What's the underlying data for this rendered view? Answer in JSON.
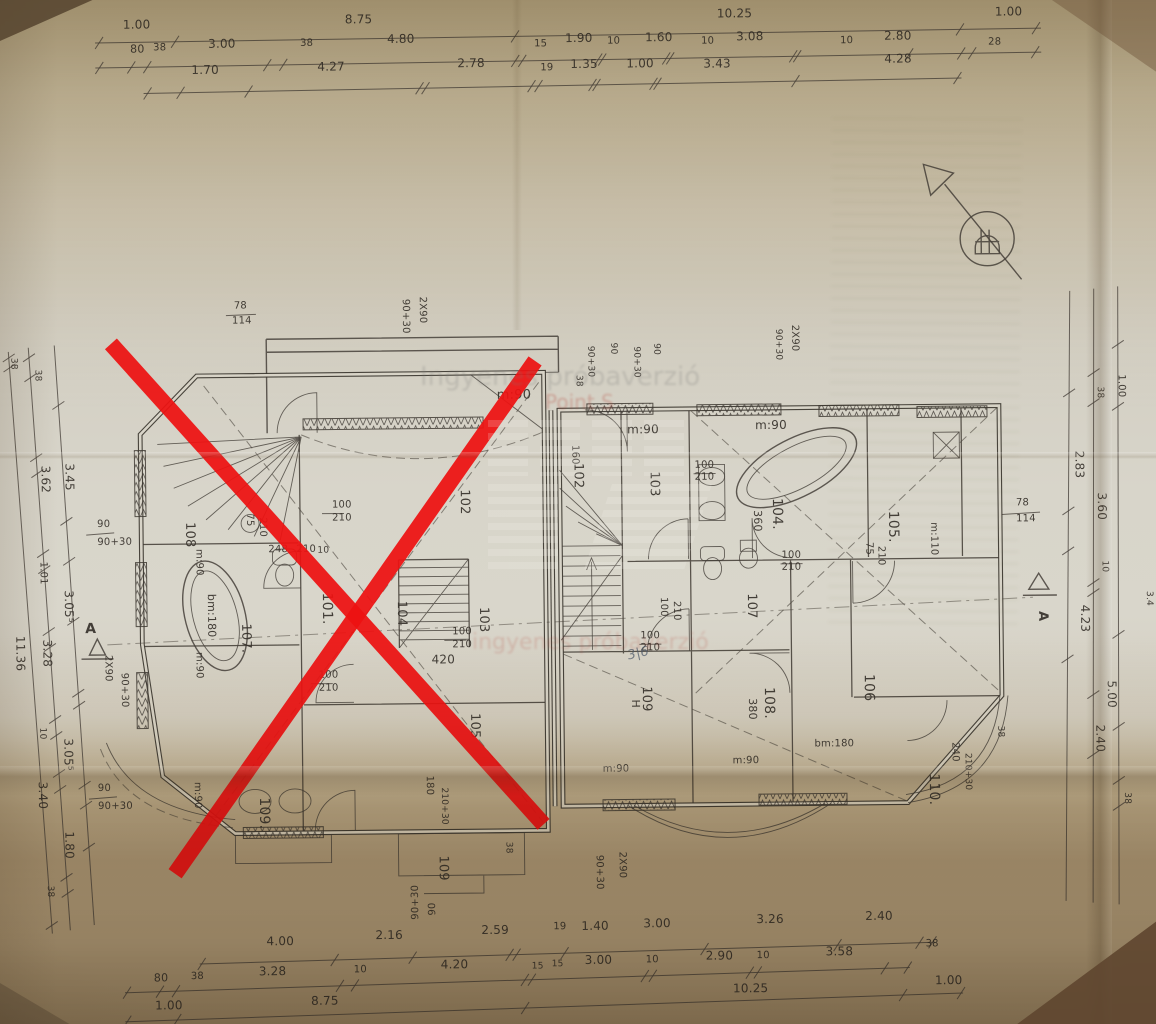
{
  "watermarks": {
    "trial_text_gray": "Ingyenes próbaverzió",
    "trial_text_red": "Point S",
    "trial_text_red2": "ingyenes próbaverzió"
  },
  "rooms": {
    "left_wing_crossed_out": [
      "101.",
      "102",
      "103",
      "104",
      "105",
      "107.",
      "108",
      "109.",
      "109"
    ],
    "right_wing": [
      "102",
      "103",
      "104.",
      "105.",
      "106",
      "107",
      "108.",
      "109",
      "110."
    ]
  },
  "dimension_rows": {
    "top_row1": [
      "1.00",
      "8.75",
      "10.25",
      "1.00"
    ],
    "top_row2": [
      "80",
      "38",
      "3.00",
      "38",
      "4.80",
      "15",
      "1.90",
      "10",
      "1.60",
      "10",
      "3.08",
      "10",
      "2.80",
      "28"
    ],
    "top_row3": [
      "1.70",
      "4.27",
      "2.78",
      "19",
      "1.35",
      "1.00",
      "3.43",
      "4.28"
    ],
    "bottom_row1": [
      "4.00",
      "2.16",
      "2.59",
      "19",
      "1.40",
      "3.00",
      "3.26",
      "2.40",
      "38"
    ],
    "bottom_row2": [
      "80",
      "38",
      "3.28",
      "10",
      "4.20",
      "15",
      "15",
      "3.00",
      "10",
      "2.90",
      "10",
      "3.58"
    ],
    "bottom_row3": [
      "1.00",
      "8.75",
      "10.25",
      "1.00"
    ],
    "left_side": [
      "38",
      "38",
      "3.62",
      "3.45",
      "90",
      "90+30",
      "1.01",
      "3.05⁵",
      "11.36",
      "3.28",
      "10",
      "3.05⁵",
      "3.40",
      "90",
      "90+30",
      "1.80",
      "38"
    ],
    "right_side": [
      "1.00",
      "38",
      "2.83",
      "3.60",
      "10",
      "4.23",
      "5.00",
      "2.40",
      "38",
      "3.4",
      "78",
      "114"
    ]
  },
  "section_markers": [
    "A",
    "A"
  ],
  "labels": [
    {
      "t": "1.00",
      "x": 128,
      "y": 24,
      "g": "dim-top"
    },
    {
      "t": "8.75",
      "x": 350,
      "y": 21,
      "g": "dim-top"
    },
    {
      "t": "10.25",
      "x": 722,
      "y": 19,
      "g": "dim-top"
    },
    {
      "t": "1.00",
      "x": 1000,
      "y": 20,
      "g": "dim-top"
    },
    {
      "t": "80",
      "x": 135,
      "y": 48,
      "s": 11,
      "g": "dim-top"
    },
    {
      "t": "38",
      "x": 158,
      "y": 46,
      "s": 10,
      "g": "dim-top"
    },
    {
      "t": "3.00",
      "x": 213,
      "y": 44,
      "g": "dim-top"
    },
    {
      "t": "38",
      "x": 305,
      "y": 43,
      "s": 10,
      "g": "dim-top"
    },
    {
      "t": "4.80",
      "x": 392,
      "y": 41,
      "g": "dim-top"
    },
    {
      "t": "15",
      "x": 539,
      "y": 46,
      "s": 10,
      "g": "dim-top"
    },
    {
      "t": "1.90",
      "x": 570,
      "y": 42,
      "g": "dim-top"
    },
    {
      "t": "10",
      "x": 612,
      "y": 44,
      "s": 10,
      "g": "dim-top"
    },
    {
      "t": "1.60",
      "x": 650,
      "y": 42,
      "g": "dim-top"
    },
    {
      "t": "10",
      "x": 706,
      "y": 45,
      "s": 10,
      "g": "dim-top"
    },
    {
      "t": "3.08",
      "x": 741,
      "y": 42,
      "g": "dim-top"
    },
    {
      "t": "10",
      "x": 845,
      "y": 46,
      "s": 10,
      "g": "dim-top"
    },
    {
      "t": "2.80",
      "x": 889,
      "y": 43,
      "g": "dim-top"
    },
    {
      "t": "28",
      "x": 993,
      "y": 49,
      "s": 10,
      "g": "dim-top"
    },
    {
      "t": "1.70",
      "x": 196,
      "y": 70,
      "g": "dim-top"
    },
    {
      "t": "4.27",
      "x": 322,
      "y": 68,
      "g": "dim-top"
    },
    {
      "t": "2.78",
      "x": 462,
      "y": 66,
      "g": "dim-top"
    },
    {
      "t": "19",
      "x": 545,
      "y": 70,
      "s": 10,
      "g": "dim-top"
    },
    {
      "t": "1.35",
      "x": 575,
      "y": 68,
      "g": "dim-top"
    },
    {
      "t": "1.00",
      "x": 631,
      "y": 68,
      "g": "dim-top"
    },
    {
      "t": "3.43",
      "x": 708,
      "y": 69,
      "g": "dim-top"
    },
    {
      "t": "4.28",
      "x": 889,
      "y": 66,
      "g": "dim-top"
    },
    {
      "t": "4.00",
      "x": 262,
      "y": 942,
      "g": "dim-bottom"
    },
    {
      "t": "2.16",
      "x": 371,
      "y": 937,
      "g": "dim-bottom"
    },
    {
      "t": "2.59",
      "x": 477,
      "y": 933,
      "g": "dim-bottom"
    },
    {
      "t": "19",
      "x": 549,
      "y": 929,
      "s": 10,
      "g": "dim-bottom"
    },
    {
      "t": "1.40",
      "x": 577,
      "y": 930,
      "g": "dim-bottom"
    },
    {
      "t": "3.00",
      "x": 639,
      "y": 928,
      "g": "dim-bottom"
    },
    {
      "t": "3.26",
      "x": 752,
      "y": 925,
      "g": "dim-bottom"
    },
    {
      "t": "2.40",
      "x": 861,
      "y": 923,
      "g": "dim-bottom"
    },
    {
      "t": "38",
      "x": 921,
      "y": 950,
      "s": 10,
      "g": "dim-bottom"
    },
    {
      "t": "80",
      "x": 149,
      "y": 977,
      "s": 11,
      "g": "dim-bottom"
    },
    {
      "t": "38",
      "x": 186,
      "y": 975,
      "s": 10,
      "g": "dim-bottom"
    },
    {
      "t": "3.28",
      "x": 254,
      "y": 972,
      "g": "dim-bottom"
    },
    {
      "t": "10",
      "x": 349,
      "y": 970,
      "s": 10,
      "g": "dim-bottom"
    },
    {
      "t": "4.20",
      "x": 436,
      "y": 967,
      "g": "dim-bottom"
    },
    {
      "t": "15",
      "x": 527,
      "y": 968,
      "s": 9,
      "g": "dim-bottom"
    },
    {
      "t": "15",
      "x": 547,
      "y": 966,
      "s": 9,
      "g": "dim-bottom"
    },
    {
      "t": "3.00",
      "x": 580,
      "y": 964,
      "g": "dim-bottom"
    },
    {
      "t": "10",
      "x": 641,
      "y": 963,
      "s": 10,
      "g": "dim-bottom"
    },
    {
      "t": "2.90",
      "x": 701,
      "y": 961,
      "g": "dim-bottom"
    },
    {
      "t": "10",
      "x": 752,
      "y": 960,
      "s": 10,
      "g": "dim-bottom"
    },
    {
      "t": "3.58",
      "x": 821,
      "y": 958,
      "g": "dim-bottom"
    },
    {
      "t": "1.00",
      "x": 150,
      "y": 1005,
      "g": "dim-bottom"
    },
    {
      "t": "8.75",
      "x": 306,
      "y": 1002,
      "g": "dim-bottom"
    },
    {
      "t": "10.25",
      "x": 728,
      "y": 994,
      "g": "dim-bottom"
    },
    {
      "t": "1.00",
      "x": 930,
      "y": 988,
      "g": "dim-bottom"
    },
    {
      "t": "90+30",
      "x": 414,
      "y": 918,
      "r": -90,
      "s": 10,
      "g": "dim-bottom"
    },
    {
      "t": "90",
      "x": 431,
      "y": 914,
      "r": -90,
      "s": 10,
      "g": "dim-bottom"
    },
    {
      "t": "38",
      "x": 13,
      "y": 352,
      "r": 90,
      "s": 9,
      "g": "dim-left"
    },
    {
      "t": "11.36",
      "x": 15,
      "y": 630,
      "r": 90,
      "s": 12,
      "g": "dim-left"
    },
    {
      "t": "38",
      "x": 37,
      "y": 364,
      "r": 90,
      "s": 9,
      "g": "dim-left"
    },
    {
      "t": "3.62",
      "x": 42,
      "y": 460,
      "r": 90,
      "g": "dim-left"
    },
    {
      "t": "1.01",
      "x": 40,
      "y": 556,
      "r": 90,
      "s": 10,
      "g": "dim-left"
    },
    {
      "t": "3.28",
      "x": 42,
      "y": 634,
      "r": 90,
      "g": "dim-left"
    },
    {
      "t": "10",
      "x": 38,
      "y": 722,
      "r": 90,
      "s": 9,
      "g": "dim-left"
    },
    {
      "t": "3.40",
      "x": 36,
      "y": 776,
      "r": 90,
      "g": "dim-left"
    },
    {
      "t": "38",
      "x": 44,
      "y": 880,
      "r": 90,
      "s": 9,
      "g": "dim-left"
    },
    {
      "t": "3.45",
      "x": 66,
      "y": 458,
      "r": 90,
      "g": "dim-left"
    },
    {
      "t": "3.05⁵",
      "x": 64,
      "y": 585,
      "r": 90,
      "g": "dim-left"
    },
    {
      "t": "3.05⁵",
      "x": 62,
      "y": 733,
      "r": 90,
      "g": "dim-left"
    },
    {
      "t": "1.80",
      "x": 62,
      "y": 826,
      "r": 90,
      "g": "dim-left"
    },
    {
      "t": "90",
      "x": 97,
      "y": 522,
      "s": 10,
      "g": "dim-left"
    },
    {
      "t": "90+30",
      "x": 97,
      "y": 540,
      "s": 10,
      "g": "dim-left"
    },
    {
      "t": "90",
      "x": 95,
      "y": 786,
      "s": 10,
      "g": "dim-left"
    },
    {
      "t": "90+30",
      "x": 95,
      "y": 804,
      "s": 10,
      "g": "dim-left"
    },
    {
      "t": "A",
      "x": 84,
      "y": 628,
      "s": 14,
      "w": 700,
      "g": "section-marker"
    },
    {
      "t": "2X90",
      "x": 104,
      "y": 650,
      "r": 90,
      "s": 10,
      "g": "dim-left"
    },
    {
      "t": "90+30",
      "x": 120,
      "y": 668,
      "r": 90,
      "s": 10,
      "g": "dim-left"
    },
    {
      "t": "1.00",
      "x": 1120,
      "y": 380,
      "r": 90,
      "s": 10,
      "g": "dim-right"
    },
    {
      "t": "38",
      "x": 1099,
      "y": 392,
      "r": 90,
      "s": 9,
      "g": "dim-right"
    },
    {
      "t": "2.83",
      "x": 1076,
      "y": 456,
      "r": 90,
      "g": "dim-right"
    },
    {
      "t": "3.60",
      "x": 1098,
      "y": 498,
      "r": 90,
      "g": "dim-right"
    },
    {
      "t": "10",
      "x": 1102,
      "y": 566,
      "r": 90,
      "s": 9,
      "g": "dim-right"
    },
    {
      "t": "4.23",
      "x": 1080,
      "y": 610,
      "r": 90,
      "g": "dim-right"
    },
    {
      "t": "5.00",
      "x": 1106,
      "y": 686,
      "r": 90,
      "g": "dim-right"
    },
    {
      "t": "2.40",
      "x": 1094,
      "y": 730,
      "r": 90,
      "g": "dim-right"
    },
    {
      "t": "38",
      "x": 1122,
      "y": 798,
      "r": 90,
      "s": 9,
      "g": "dim-right"
    },
    {
      "t": "3.4",
      "x": 1146,
      "y": 597,
      "r": 90,
      "s": 9,
      "g": "dim-right"
    },
    {
      "t": "78",
      "x": 1016,
      "y": 510,
      "s": 10,
      "g": "dim-right"
    },
    {
      "t": "114",
      "x": 1016,
      "y": 526,
      "s": 10,
      "g": "dim-right"
    },
    {
      "t": "A",
      "x": 1038,
      "y": 616,
      "r": 90,
      "s": 13,
      "w": 700,
      "g": "section-marker"
    },
    {
      "t": "78",
      "x": 236,
      "y": 305,
      "s": 10,
      "g": "plan-left"
    },
    {
      "t": "114",
      "x": 234,
      "y": 320,
      "s": 10,
      "g": "plan-left"
    },
    {
      "t": "90+30",
      "x": 405,
      "y": 297,
      "r": 90,
      "s": 10,
      "g": "plan-left"
    },
    {
      "t": "2X90",
      "x": 422,
      "y": 295,
      "r": 90,
      "s": 10,
      "g": "plan-left"
    },
    {
      "t": "m:90",
      "x": 498,
      "y": 398,
      "s": 13,
      "g": "plan-left"
    },
    {
      "t": "108",
      "x": 186,
      "y": 518,
      "r": 90,
      "s": 13,
      "g": "plan-left"
    },
    {
      "t": "75",
      "x": 247,
      "y": 510,
      "r": 90,
      "s": 10,
      "g": "plan-left"
    },
    {
      "t": "210",
      "x": 260,
      "y": 514,
      "r": 90,
      "s": 10,
      "g": "plan-left"
    },
    {
      "t": "m:90",
      "x": 196,
      "y": 545,
      "r": 90,
      "s": 10,
      "g": "plan-left"
    },
    {
      "t": "bm:180",
      "x": 207,
      "y": 590,
      "r": 90,
      "s": 11,
      "g": "plan-left"
    },
    {
      "t": "m:90",
      "x": 195,
      "y": 648,
      "r": 90,
      "s": 10,
      "g": "plan-left"
    },
    {
      "t": "107.",
      "x": 241,
      "y": 620,
      "r": 90,
      "s": 13,
      "g": "plan-left"
    },
    {
      "t": "101.",
      "x": 322,
      "y": 590,
      "r": 90,
      "s": 14,
      "g": "plan-left"
    },
    {
      "t": "104",
      "x": 397,
      "y": 599,
      "r": 90,
      "s": 13,
      "g": "plan-left"
    },
    {
      "t": "103",
      "x": 479,
      "y": 606,
      "r": 90,
      "s": 13,
      "g": "plan-left"
    },
    {
      "t": "102",
      "x": 461,
      "y": 488,
      "r": 90,
      "s": 13,
      "g": "plan-left"
    },
    {
      "t": "105",
      "x": 469,
      "y": 712,
      "r": 90,
      "s": 13,
      "g": "plan-left"
    },
    {
      "t": "100",
      "x": 332,
      "y": 505,
      "s": 10,
      "g": "plan-left"
    },
    {
      "t": "210",
      "x": 332,
      "y": 518,
      "s": 10,
      "g": "plan-left"
    },
    {
      "t": "248",
      "x": 268,
      "y": 549,
      "s": 10,
      "g": "plan-left"
    },
    {
      "t": "210",
      "x": 296,
      "y": 549,
      "s": 10,
      "g": "plan-left"
    },
    {
      "t": "10",
      "x": 317,
      "y": 550,
      "s": 9,
      "g": "plan-left"
    },
    {
      "t": "100",
      "x": 451,
      "y": 633,
      "s": 10,
      "g": "plan-left"
    },
    {
      "t": "210",
      "x": 451,
      "y": 646,
      "s": 10,
      "g": "plan-left"
    },
    {
      "t": "100",
      "x": 317,
      "y": 675,
      "s": 10,
      "g": "plan-left"
    },
    {
      "t": "210",
      "x": 317,
      "y": 688,
      "s": 10,
      "g": "plan-left"
    },
    {
      "t": "420",
      "x": 430,
      "y": 662,
      "s": 12,
      "g": "plan-left"
    },
    {
      "t": "m:90",
      "x": 192,
      "y": 778,
      "r": 90,
      "s": 10,
      "g": "plan-left"
    },
    {
      "t": "109.",
      "x": 257,
      "y": 794,
      "r": 90,
      "s": 14,
      "g": "plan-left"
    },
    {
      "t": "109",
      "x": 436,
      "y": 854,
      "r": 90,
      "s": 13,
      "g": "plan-left"
    },
    {
      "t": "180",
      "x": 424,
      "y": 774,
      "r": 90,
      "s": 10,
      "g": "plan-left"
    },
    {
      "t": "210+30",
      "x": 439,
      "y": 786,
      "r": 90,
      "s": 9,
      "g": "plan-left"
    },
    {
      "t": "38",
      "x": 503,
      "y": 841,
      "r": 90,
      "s": 9,
      "g": "plan-left"
    },
    {
      "t": "90+30",
      "x": 593,
      "y": 855,
      "r": 90,
      "s": 10,
      "g": "plan-left"
    },
    {
      "t": "2X90",
      "x": 616,
      "y": 852,
      "r": 90,
      "s": 10,
      "g": "plan-left"
    },
    {
      "t": "38",
      "x": 578,
      "y": 375,
      "r": 90,
      "s": 9,
      "g": "plan-right"
    },
    {
      "t": "90+30",
      "x": 590,
      "y": 346,
      "r": 90,
      "s": 9,
      "g": "plan-right"
    },
    {
      "t": "90",
      "x": 613,
      "y": 343,
      "r": 90,
      "s": 9,
      "g": "plan-right"
    },
    {
      "t": "90+30",
      "x": 636,
      "y": 347,
      "r": 90,
      "s": 9,
      "g": "plan-right"
    },
    {
      "t": "90",
      "x": 656,
      "y": 344,
      "r": 90,
      "s": 9,
      "g": "plan-right"
    },
    {
      "t": "90+30",
      "x": 778,
      "y": 331,
      "r": 90,
      "s": 9,
      "g": "plan-right"
    },
    {
      "t": "2X90",
      "x": 794,
      "y": 327,
      "r": 90,
      "s": 10,
      "g": "plan-right"
    },
    {
      "t": "m:90",
      "x": 628,
      "y": 434,
      "s": 12,
      "g": "plan-right"
    },
    {
      "t": "m:90",
      "x": 756,
      "y": 431,
      "s": 12,
      "g": "plan-right"
    },
    {
      "t": "160",
      "x": 573,
      "y": 445,
      "r": 90,
      "s": 10,
      "g": "plan-right"
    },
    {
      "t": "102",
      "x": 575,
      "y": 463,
      "r": 90,
      "s": 13,
      "g": "plan-right"
    },
    {
      "t": "103",
      "x": 651,
      "y": 472,
      "r": 90,
      "s": 13,
      "g": "plan-right"
    },
    {
      "t": "104.",
      "x": 773,
      "y": 500,
      "r": 90,
      "s": 14,
      "g": "plan-right"
    },
    {
      "t": "360",
      "x": 754,
      "y": 512,
      "r": 90,
      "s": 11,
      "g": "plan-right"
    },
    {
      "t": "105.",
      "x": 889,
      "y": 514,
      "r": 90,
      "s": 14,
      "g": "plan-right"
    },
    {
      "t": "m:110",
      "x": 931,
      "y": 526,
      "r": 90,
      "s": 10,
      "g": "plan-right"
    },
    {
      "t": "75",
      "x": 866,
      "y": 545,
      "r": 90,
      "s": 10,
      "g": "plan-right"
    },
    {
      "t": "210",
      "x": 878,
      "y": 549,
      "r": 90,
      "s": 10,
      "g": "plan-right"
    },
    {
      "t": "107",
      "x": 747,
      "y": 595,
      "r": 90,
      "s": 13,
      "g": "plan-right"
    },
    {
      "t": "106",
      "x": 863,
      "y": 677,
      "r": 90,
      "s": 14,
      "g": "plan-right"
    },
    {
      "t": "108.",
      "x": 763,
      "y": 689,
      "r": 90,
      "s": 14,
      "g": "plan-right"
    },
    {
      "t": "380",
      "x": 747,
      "y": 700,
      "r": 90,
      "s": 11,
      "g": "plan-right"
    },
    {
      "t": "109",
      "x": 641,
      "y": 687,
      "r": 90,
      "s": 13,
      "g": "plan-right"
    },
    {
      "t": "H",
      "x": 630,
      "y": 700,
      "r": 90,
      "s": 11,
      "g": "plan-right"
    },
    {
      "t": "110.",
      "x": 927,
      "y": 777,
      "r": 90,
      "s": 14,
      "g": "plan-right"
    },
    {
      "t": "240",
      "x": 950,
      "y": 746,
      "r": 90,
      "s": 10,
      "g": "plan-right"
    },
    {
      "t": "210+30",
      "x": 963,
      "y": 757,
      "r": 90,
      "s": 9,
      "g": "plan-right"
    },
    {
      "t": "bm:180",
      "x": 812,
      "y": 749,
      "s": 10,
      "g": "plan-right"
    },
    {
      "t": "m:90",
      "x": 600,
      "y": 772,
      "s": 10,
      "g": "plan-right"
    },
    {
      "t": "m:90",
      "x": 730,
      "y": 765,
      "s": 10,
      "g": "plan-right"
    },
    {
      "t": "100",
      "x": 695,
      "y": 469,
      "s": 10,
      "g": "plan-right"
    },
    {
      "t": "210",
      "x": 695,
      "y": 481,
      "s": 10,
      "g": "plan-right"
    },
    {
      "t": "100",
      "x": 781,
      "y": 560,
      "s": 10,
      "g": "plan-right"
    },
    {
      "t": "210",
      "x": 781,
      "y": 572,
      "s": 10,
      "g": "plan-right"
    },
    {
      "t": "100",
      "x": 639,
      "y": 639,
      "s": 10,
      "g": "plan-right"
    },
    {
      "t": "210",
      "x": 639,
      "y": 651,
      "s": 10,
      "g": "plan-right"
    },
    {
      "t": "100",
      "x": 660,
      "y": 598,
      "r": 90,
      "s": 10,
      "g": "plan-right"
    },
    {
      "t": "210",
      "x": 673,
      "y": 602,
      "r": 90,
      "s": 10,
      "g": "plan-right"
    },
    {
      "t": "38",
      "x": 996,
      "y": 730,
      "r": 90,
      "s": 9,
      "g": "plan-right"
    },
    {
      "t": "3|6",
      "x": 627,
      "y": 660,
      "r": -12,
      "s": 13,
      "c": "pencil",
      "g": "handwritten-note"
    }
  ]
}
